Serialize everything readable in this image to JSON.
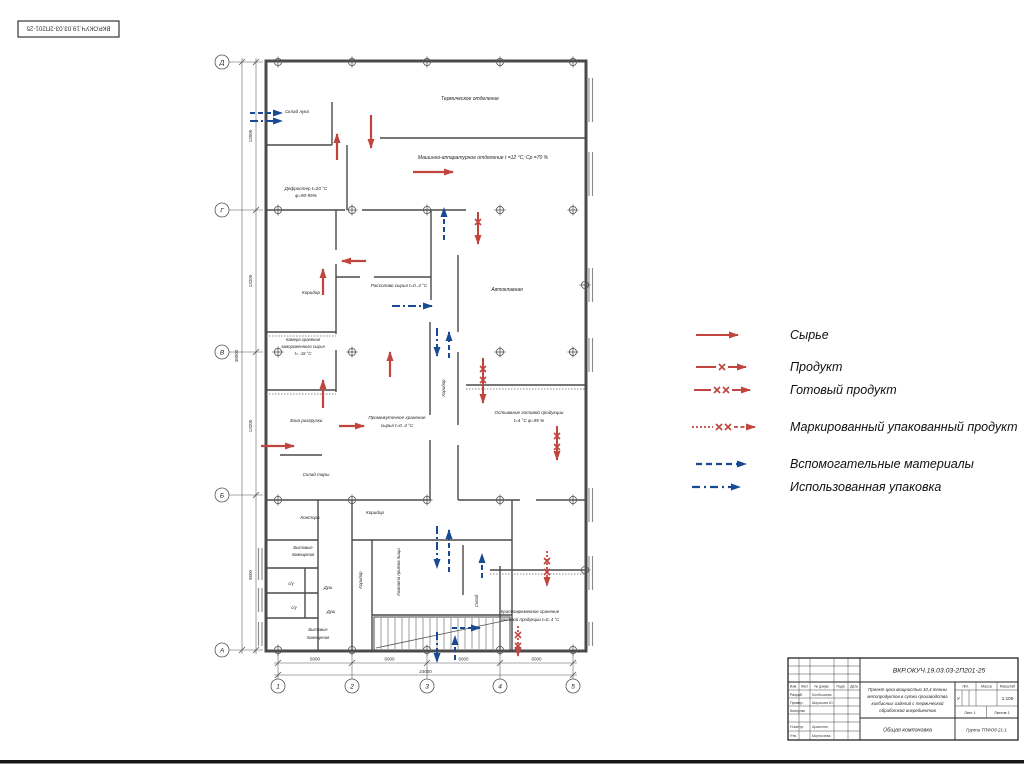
{
  "stamp": {
    "code": "ВКР.ОКУЧ.19.03.03-2П201-25"
  },
  "plan": {
    "axes_left": [
      "Д",
      "Г",
      "В",
      "Б",
      "А"
    ],
    "axes_bottom": [
      "1",
      "2",
      "3",
      "4",
      "5"
    ],
    "dims_left": [
      "12000",
      "13200",
      "13200",
      "9600"
    ],
    "dims_left_total": "48000",
    "dims_bottom": [
      "6000",
      "6000",
      "6000",
      "6000"
    ],
    "dims_bottom_total": "24000",
    "labels": {
      "thermal": "Термическое отделение",
      "onion_storage": "Склад лука",
      "machine_dept": "Машинно-аппаратурное отделение t =12 °С; Ср =70 %",
      "defroster_1": "Дефростер t=20 °С",
      "defroster_2": "φ=90-95%",
      "corridor": "Коридор",
      "brine_raw": "Рассолово сырья  t=0..4 °С",
      "autoclave": "Автоклавная",
      "freezer_1": "Камера хранения",
      "freezer_2": "замороженного сырья",
      "freezer_3": "t= -18 °С",
      "unloading": "Зона разгрузки",
      "interim_1": "Промежуточное хранение",
      "interim_2": "сырья  t=0..4 °С",
      "cooling_1": "Остывание готовой продукции",
      "cooling_2": "t=4 °С  φ=95 %",
      "tare_storage": "Склад тары",
      "office": "Контора",
      "household_1": "Бытовые",
      "household_2": "помещения",
      "wc": "с/у",
      "shower": "Душ",
      "meal_room": "Комната приема пищи",
      "storage": "Склад",
      "shortterm_1": "Кратковременное хранение",
      "shortterm_2": "готовой продукции  t=0..4 °С"
    }
  },
  "legend": {
    "items": [
      {
        "label": "Сырье",
        "kind": "raw-solid-red-arrow"
      },
      {
        "label": "Продукт",
        "kind": "red-arrow-one-x"
      },
      {
        "label": "Готовый продукт",
        "kind": "red-arrow-two-x"
      },
      {
        "label": "Маркированный упакованный продукт",
        "kind": "red-dotted-two-x"
      },
      {
        "label": "Вспомогательные материалы",
        "kind": "blue-dashed-arrow"
      },
      {
        "label": "Использованная упаковка",
        "kind": "blue-dashdot-arrow"
      }
    ]
  },
  "colors": {
    "flow_red": "#c0453e",
    "flow_blue": "#1b4a94",
    "line": "#4a4a4a"
  },
  "titleblock": {
    "code": "ВКР.ОКУЧ.19.03.03-2П201-25",
    "header_cols": [
      "Изм.",
      "Лист",
      "№ докум.",
      "Подп.",
      "Дата"
    ],
    "rows": [
      {
        "role": "Разраб.",
        "name": "Колбышева"
      },
      {
        "role": "Провер.",
        "name": "Ширшова Ю."
      },
      {
        "role": "Консульт.",
        "name": ""
      },
      {
        "role": "Н.контр.",
        "name": "Аракелян"
      },
      {
        "role": "Утв.",
        "name": "Мкртычева"
      }
    ],
    "project_lines": [
      "Проект цеха мощностью 10,4 тонны",
      "мясопродуктов в сутки производства",
      "колбасных изделий с термической",
      "обработкой ингредиентов"
    ],
    "lit_header": "Лит.",
    "mass_header": "Масса",
    "scale_header": "Масштаб",
    "litera": "У",
    "scale": "1:100",
    "sheet": "Лист 1",
    "sheets": "Листов 1",
    "doc_type": "Общая компоновка",
    "group": "Группа ТПФОб-21-1"
  }
}
